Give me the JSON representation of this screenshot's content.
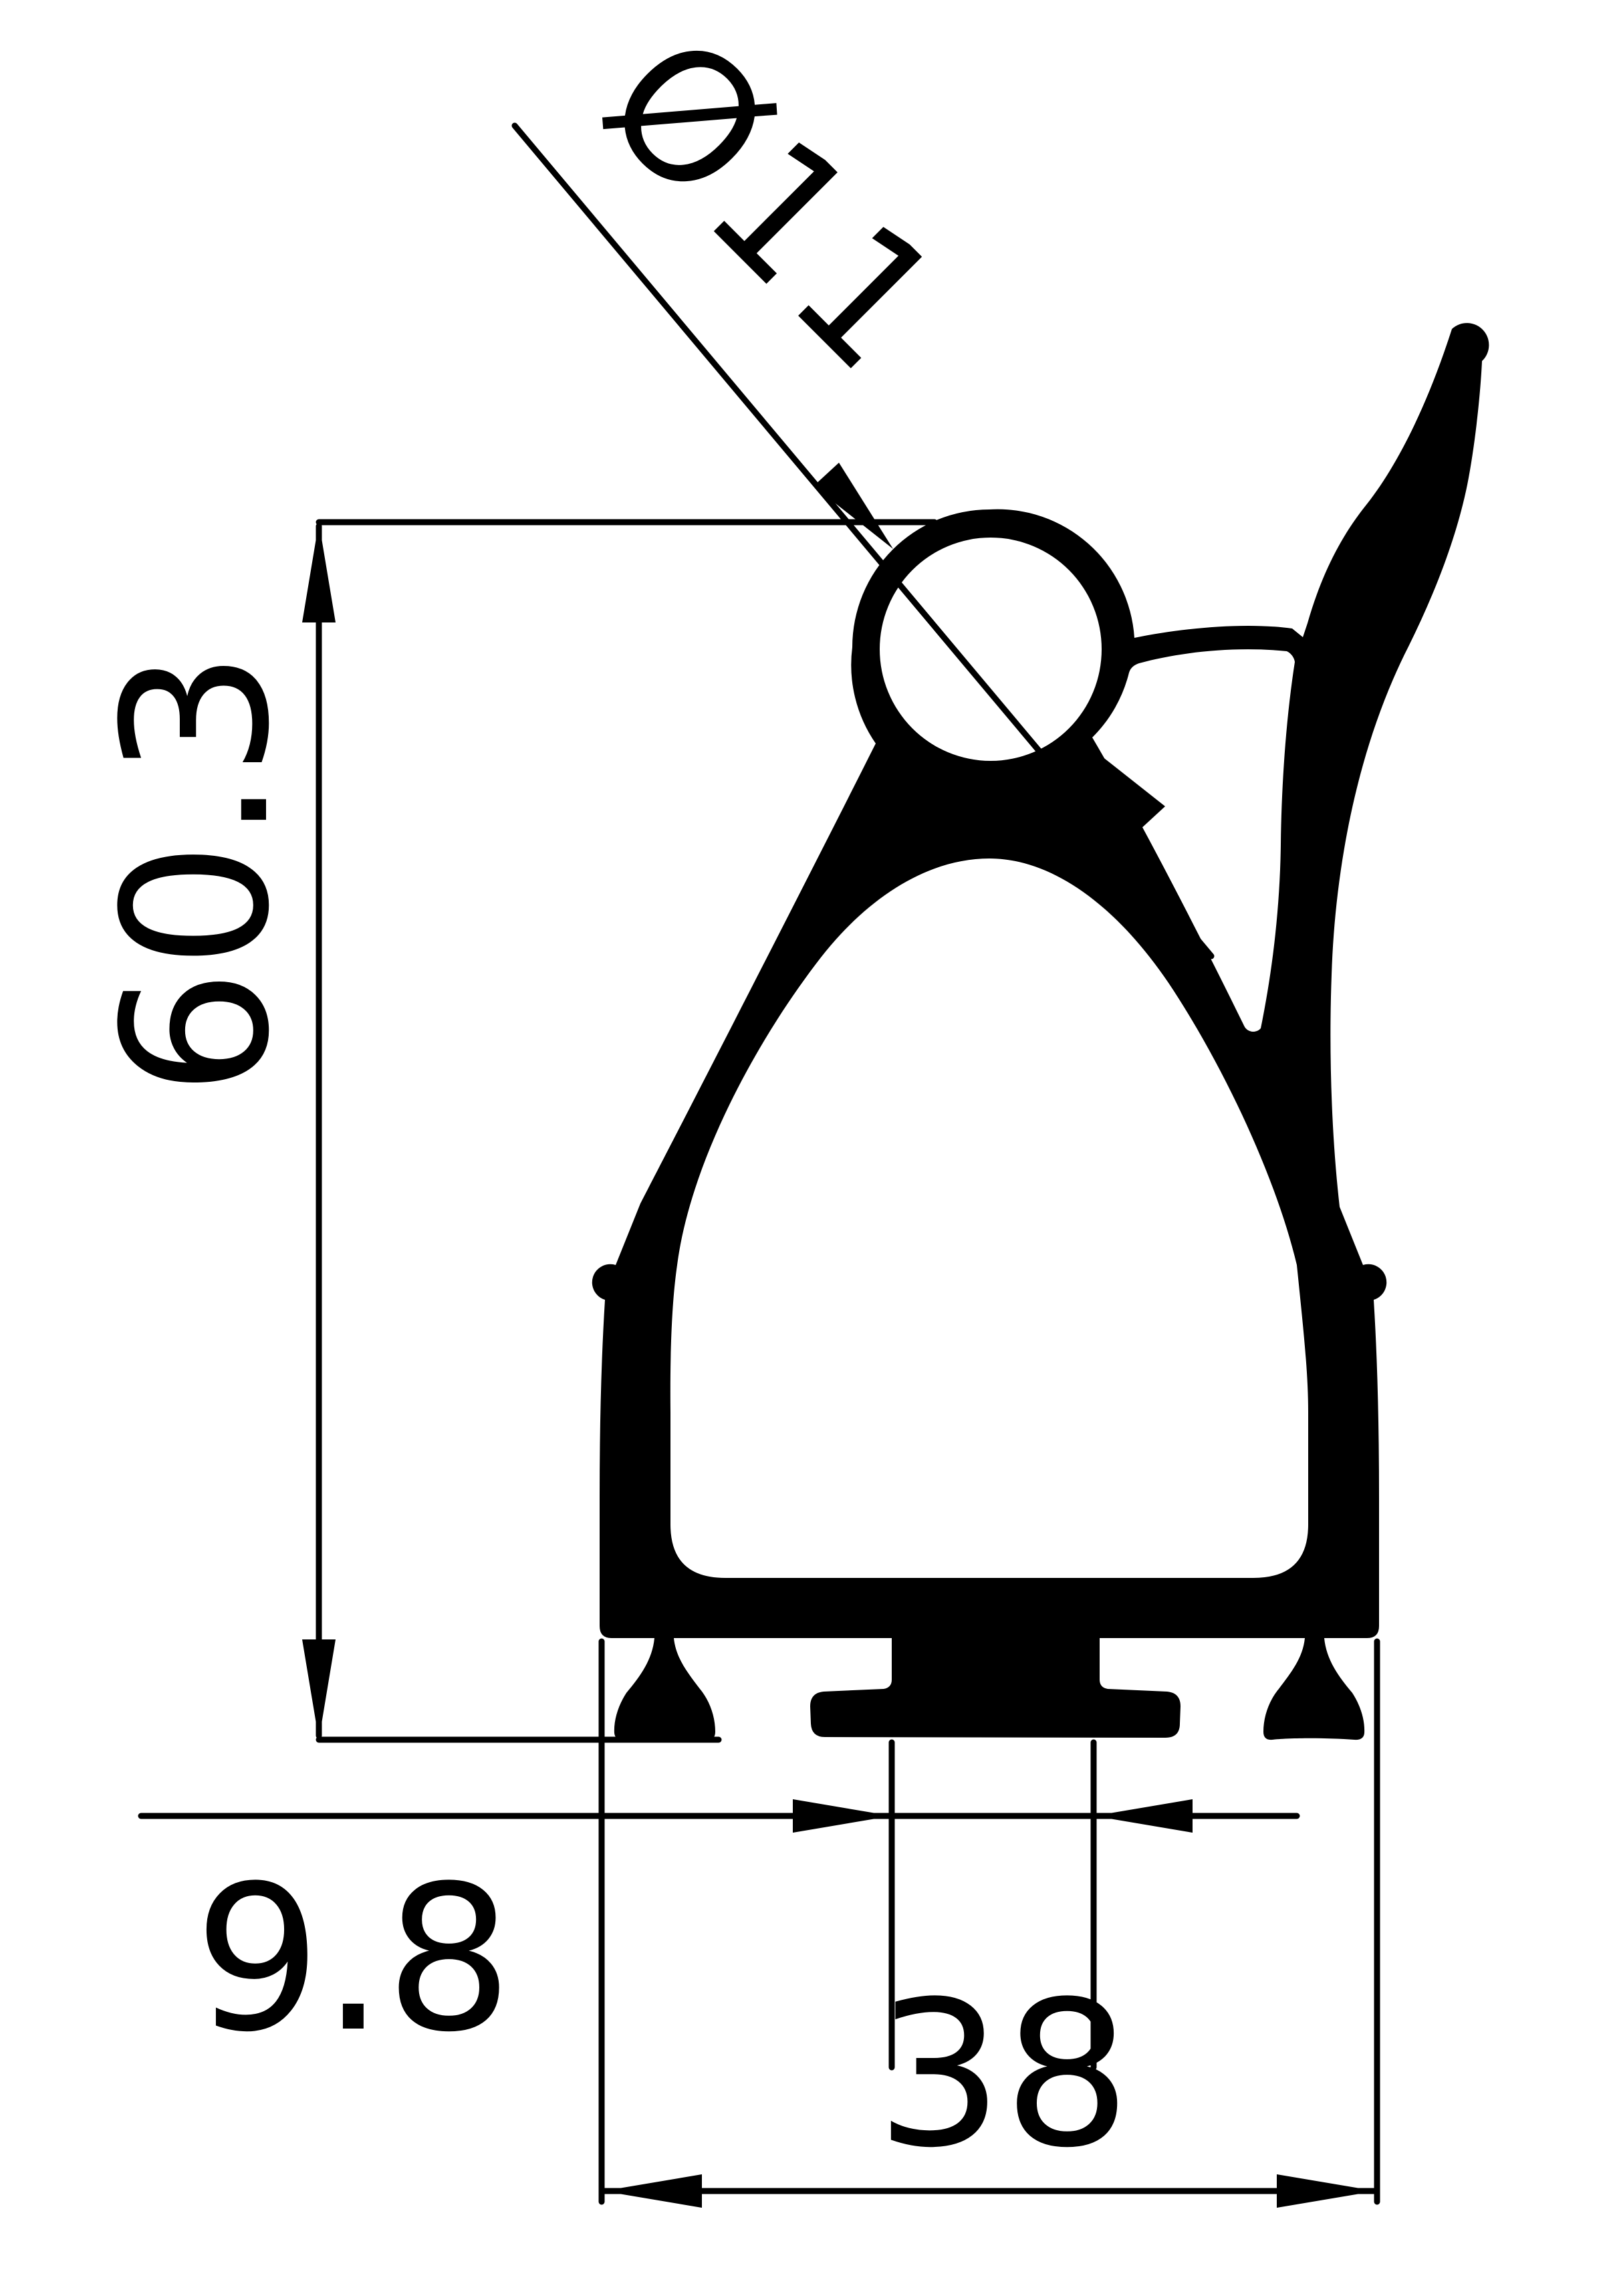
{
  "drawing": {
    "background_color": "#ffffff",
    "ink_color": "#000000",
    "dimensions": {
      "diameter": {
        "label": "Ø11"
      },
      "height": {
        "label": "60.3"
      },
      "stem_width": {
        "label": "9.8"
      },
      "base_width": {
        "label": "38"
      }
    }
  }
}
